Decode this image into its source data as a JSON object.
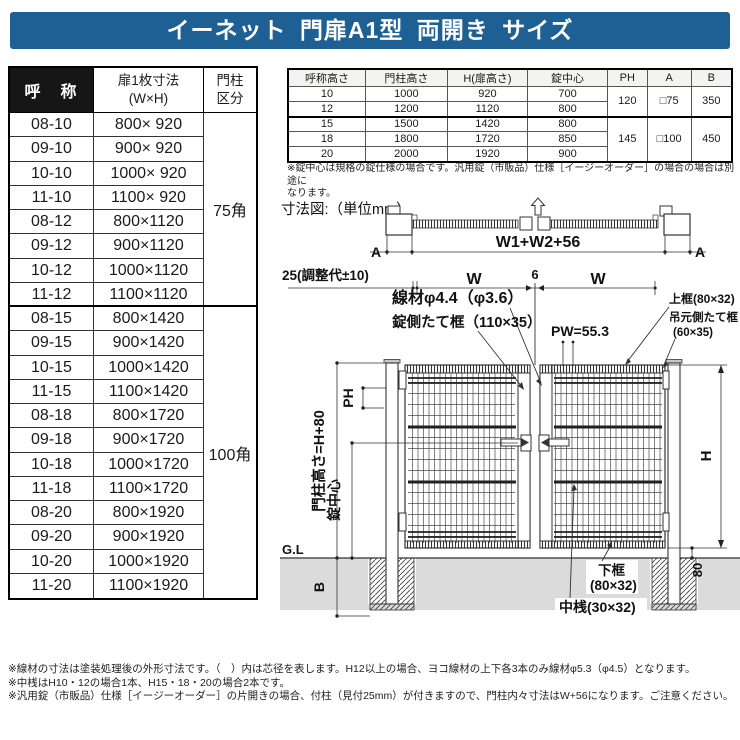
{
  "title": "イーネット 門扉A1型 両開き サイズ",
  "colors": {
    "title_bar": "#1e6094",
    "header_cell": "#161616",
    "ground": "#dbdbdb",
    "line": "#333333"
  },
  "size_table": {
    "headers": {
      "name": "呼　称",
      "dim": "扉1枚寸法\n(W×H)",
      "post": "門柱\n区分"
    },
    "rows": [
      {
        "name": "08-10",
        "dim": "800× 920"
      },
      {
        "name": "09-10",
        "dim": "900× 920"
      },
      {
        "name": "10-10",
        "dim": "1000× 920"
      },
      {
        "name": "11-10",
        "dim": "1100× 920"
      },
      {
        "name": "08-12",
        "dim": "800×1120"
      },
      {
        "name": "09-12",
        "dim": "900×1120"
      },
      {
        "name": "10-12",
        "dim": "1000×1120"
      },
      {
        "name": "11-12",
        "dim": "1100×1120"
      },
      {
        "name": "08-15",
        "dim": "800×1420"
      },
      {
        "name": "09-15",
        "dim": "900×1420"
      },
      {
        "name": "10-15",
        "dim": "1000×1420"
      },
      {
        "name": "11-15",
        "dim": "1100×1420"
      },
      {
        "name": "08-18",
        "dim": "800×1720"
      },
      {
        "name": "09-18",
        "dim": "900×1720"
      },
      {
        "name": "10-18",
        "dim": "1000×1720"
      },
      {
        "name": "11-18",
        "dim": "1100×1720"
      },
      {
        "name": "08-20",
        "dim": "800×1920"
      },
      {
        "name": "09-20",
        "dim": "900×1920"
      },
      {
        "name": "10-20",
        "dim": "1000×1920"
      },
      {
        "name": "11-20",
        "dim": "1100×1920"
      }
    ],
    "post_groups": [
      {
        "label": "75角"
      },
      {
        "label": "100角"
      }
    ]
  },
  "height_table": {
    "headers": [
      "呼称高さ",
      "門柱高さ",
      "H(扉高さ)",
      "錠中心",
      "PH",
      "A",
      "B"
    ],
    "rows": [
      {
        "h": "10",
        "post": "1000",
        "door": "920",
        "lock": "700"
      },
      {
        "h": "12",
        "post": "1200",
        "door": "1120",
        "lock": "800"
      },
      {
        "h": "15",
        "post": "1500",
        "door": "1420",
        "lock": "800"
      },
      {
        "h": "18",
        "post": "1800",
        "door": "1720",
        "lock": "850"
      },
      {
        "h": "20",
        "post": "2000",
        "door": "1920",
        "lock": "900"
      }
    ],
    "merged": {
      "ph1": "120",
      "ph2": "145",
      "a1": "□75",
      "a2": "□100",
      "b1": "350",
      "b2": "450"
    },
    "note": "※錠中心は規格の錠仕様の場合です。汎用錠（市販品）仕様［イージーオーダー］の場合の場合は別途に\nなります。"
  },
  "diagram": {
    "caption": "寸法図:（単位mm）",
    "labels": {
      "a_left": "A",
      "a_right": "A",
      "w1w2": "W1+W2+56",
      "adj": "25(調整代±10)",
      "w_left": "W",
      "six": "6",
      "w_right": "W",
      "wire": "線材φ4.4（φ3.6）",
      "lock_stile": "錠側たて框（110×35）",
      "pw": "PW=55.3",
      "top_rail": "上框(80×32)",
      "hinge_stile1": "吊元側たて框",
      "hinge_stile2": "(60×35)",
      "post_h": "門柱高さ=H+80",
      "ph": "PH",
      "lock_center": "錠中心",
      "gl": "G.L",
      "b": "B",
      "h": "H",
      "eighty": "80",
      "bottom_rail1": "下框",
      "bottom_rail2": "(80×32)",
      "mid_rail": "中桟(30×32)"
    }
  },
  "footnotes": [
    {
      "text": "※線材の寸法は塗装処理後の外形寸法です。（　）内は芯径を表します。H12以上の場合、ヨコ線材の上下各3本のみ線材φ5.3（φ4.5）となります。"
    },
    {
      "text": "※中桟はH10・12の場合1本、H15・18・20の場合2本です。"
    },
    {
      "text": "※汎用錠（市販品）仕様［イージーオーダー］の片開きの場合、付柱（見付25mm）が付きますので、門柱内々寸法はW+56になります。ご注意ください。"
    }
  ]
}
